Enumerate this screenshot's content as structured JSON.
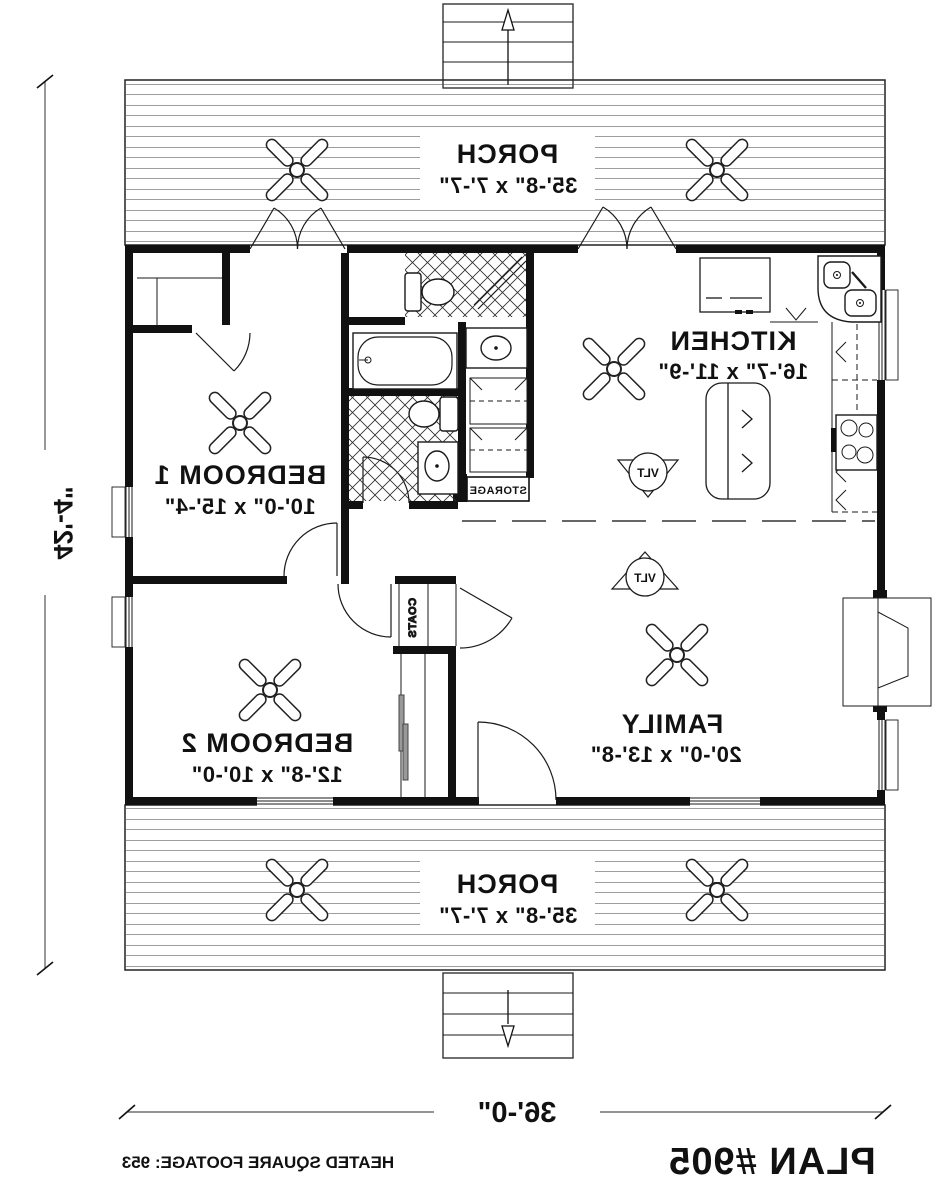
{
  "title_block": {
    "plan_number": "PLAN #905",
    "heated_sqft": "HEATED SQUARE FOOTAGE: 953"
  },
  "dimensions": {
    "overall_height": "42'-4\"",
    "overall_width": "36'-0\""
  },
  "rooms": {
    "porch_top": {
      "label": "PORCH",
      "size": "35'-8\" x 7'-7\""
    },
    "porch_bottom": {
      "label": "PORCH",
      "size": "35'-8\" x 7'-7\""
    },
    "kitchen": {
      "label": "KITCHEN",
      "size": "16'-7\" x 11'-9\""
    },
    "bedroom1": {
      "label": "BEDROOM 1",
      "size": "10'-0\" x 15'-4\""
    },
    "bedroom2": {
      "label": "BEDROOM 2",
      "size": "12'-8\" x 10'-0\""
    },
    "family": {
      "label": "FAMILY",
      "size": "20'-0\" x 13'-8\""
    },
    "storage": {
      "label": "STORAGE"
    },
    "coats": {
      "label": "COATS"
    }
  },
  "symbols": {
    "vaulted": "VLT"
  },
  "colors": {
    "line": "#1a1a1a",
    "deck_line": "#3d3d3d"
  }
}
